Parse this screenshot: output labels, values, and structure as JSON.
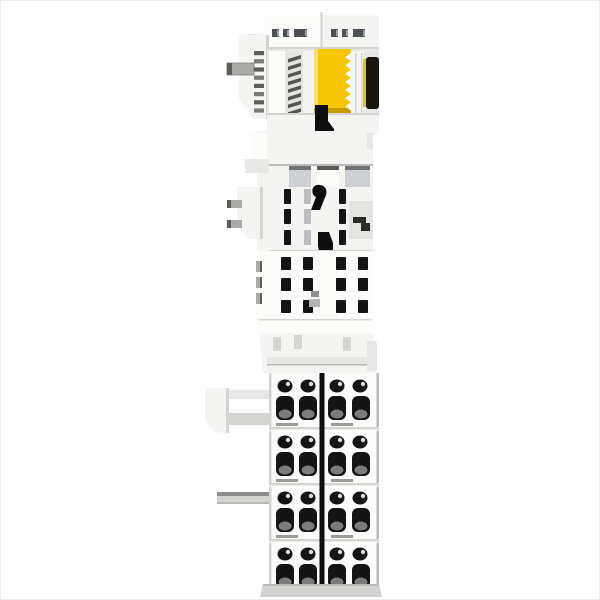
{
  "meta": {
    "type": "product-photo",
    "subject": "White modular DIN-rail I/O bus terminal block, side view, with yellow internal element, black bus contact strip and four rows of screwless wire terminals"
  },
  "palette": {
    "body": "#f4f4f2",
    "body_hi": "#fcfcfb",
    "body_lo": "#e7e7e5",
    "shade": "#d4d4d2",
    "edge": "#b9b9b7",
    "recess": "#ccd0d2",
    "recess_dark": "#6f7376",
    "hole": "#141414",
    "divider": "#0d0d0d",
    "yellow": "#f4c606",
    "yellow_hi": "#fbe06a",
    "yellow_lo": "#c79c00",
    "olive": "#cdc43e",
    "black_part": "#17150c",
    "metal": "#aaaaa8",
    "metal_dark": "#5f5d59",
    "base": "#d2d2d0"
  },
  "structure": {
    "top_cap": {
      "slot_y": 28,
      "slot_h": 8,
      "slots": [
        {
          "x": 271,
          "w": 7
        },
        {
          "x": 282,
          "w": 6
        },
        {
          "x": 293,
          "w": 13
        },
        {
          "x": 330,
          "w": 7
        },
        {
          "x": 341,
          "w": 6
        },
        {
          "x": 352,
          "w": 12
        }
      ]
    },
    "upper": {
      "wing_teeth": {
        "count": 8,
        "x": 253,
        "y0": 50,
        "step": 8.2,
        "w": 10,
        "h": 4.2
      },
      "spring_teeth": {
        "count": 8,
        "x": 287,
        "y0": 54,
        "step": 7.6,
        "w": 13,
        "h": 3.6
      },
      "yellow_teeth": {
        "count": 7,
        "x": 350,
        "y0": 52,
        "step": 8.2,
        "d": 6
      }
    },
    "mid": {
      "slot_w": 7,
      "slot_h": 15,
      "slots": [
        {
          "x": 283,
          "y": 188,
          "t": "dark"
        },
        {
          "x": 283,
          "y": 208,
          "t": "dark"
        },
        {
          "x": 283,
          "y": 229,
          "t": "dark"
        },
        {
          "x": 303,
          "y": 188,
          "t": "grey"
        },
        {
          "x": 303,
          "y": 208,
          "t": "grey"
        },
        {
          "x": 303,
          "y": 229,
          "t": "grey"
        },
        {
          "x": 338,
          "y": 188,
          "t": "dark"
        },
        {
          "x": 338,
          "y": 208,
          "t": "dark"
        },
        {
          "x": 338,
          "y": 229,
          "t": "dark"
        }
      ]
    },
    "vent_grid": {
      "cols": [
        280,
        302,
        335,
        357
      ],
      "rows": [
        256,
        277,
        299
      ],
      "w": 10,
      "h": 13,
      "metal_bits": [
        {
          "y": 260
        },
        {
          "y": 276
        },
        {
          "y": 292
        }
      ]
    },
    "terminals": {
      "group_tops": [
        372,
        428,
        484,
        540
      ],
      "seams": [
        426,
        482,
        538
      ],
      "small_cx": [
        284,
        307,
        336,
        359
      ],
      "large_cx": [
        284,
        307,
        336,
        360
      ],
      "small_cy_off": 13,
      "small_rx": 7.5,
      "small_ry": 6.5,
      "large_y_off": 23,
      "large_w": 18,
      "large_h": 24,
      "foot_y_off": 50,
      "divider_x": 318.5,
      "divider_w": 5
    }
  }
}
